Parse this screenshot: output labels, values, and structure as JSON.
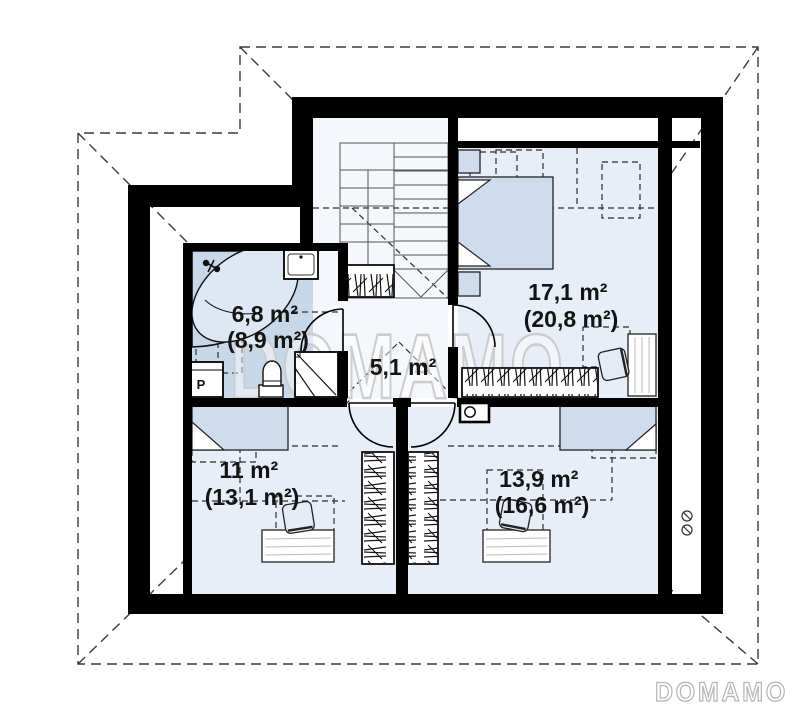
{
  "window": {
    "width": 800,
    "height": 711,
    "type": "attic-floor-plan"
  },
  "watermark": {
    "center": "DOMAMO",
    "logo": "DOMAMO"
  },
  "rooms": [
    {
      "id": "bathroom",
      "area": "6,8 m²",
      "area_total": "(8,9 m²)"
    },
    {
      "id": "hall",
      "area": "5,1 m²",
      "area_total": ""
    },
    {
      "id": "bedroom",
      "area": "17,1 m²",
      "area_total": "(20,8 m²)"
    },
    {
      "id": "room-bottom-left",
      "area": "11 m²",
      "area_total": "(13,1 m²)"
    },
    {
      "id": "room-bottom-right",
      "area": "13,9 m²",
      "area_total": "(16,6 m²)"
    }
  ],
  "appliances": {
    "washer_label": "P"
  },
  "colors": {
    "wall": "#000000",
    "bathroom_floor": "#c7d8eb",
    "room_floor": "#e7eef7",
    "hall_floor": "#f4f7fb",
    "furniture_fill": "#cfdcee",
    "watermark": "#cccccc",
    "roof_dash": "#3a3a3a"
  }
}
